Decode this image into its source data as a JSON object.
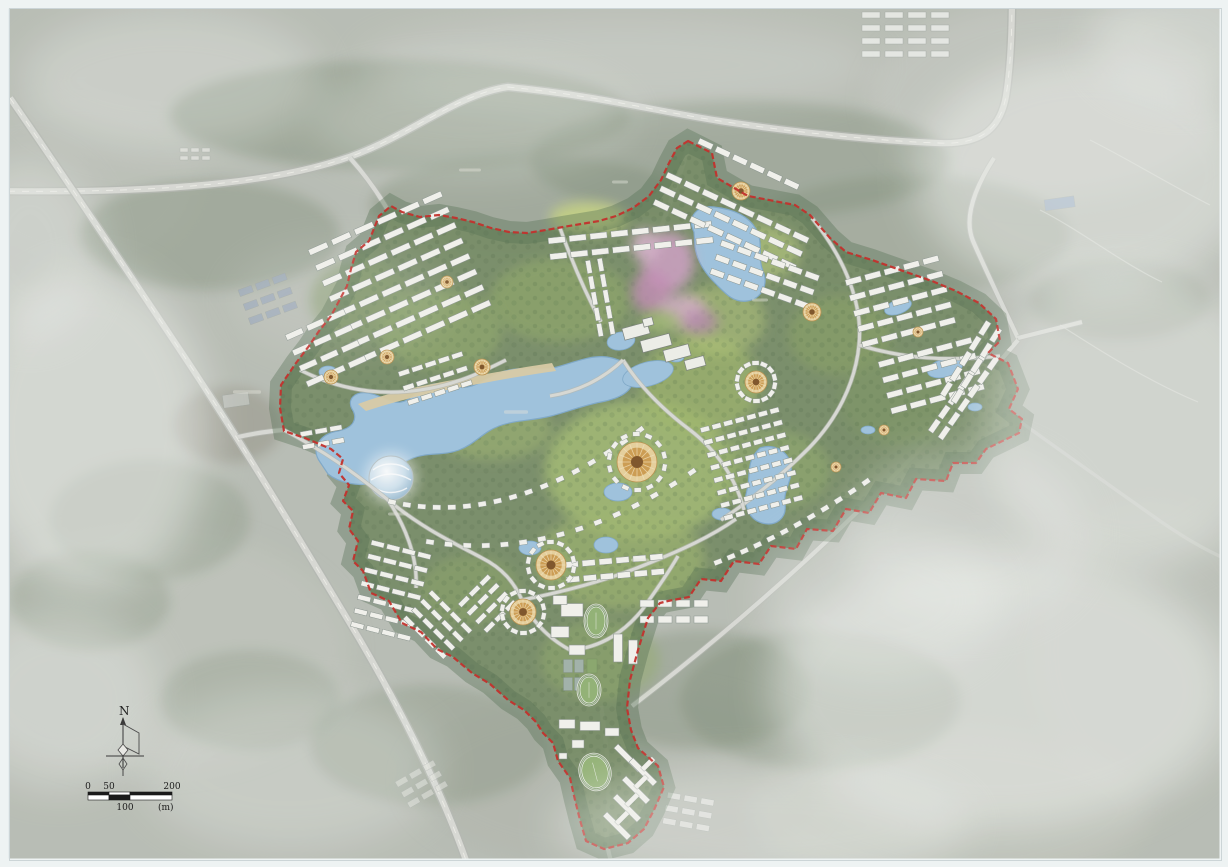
{
  "north_arrow": {
    "label": "N"
  },
  "scale_bar": {
    "tick_0": "0",
    "tick_50": "50",
    "tick_100": "100",
    "tick_200": "200",
    "unit": "(m)"
  },
  "colors": {
    "page_margin": "#eef3f3",
    "aerial_base": "#b7bcb3",
    "boundary_red": "#c22520",
    "lake_blue": "#9cc2de",
    "lake_edge": "#7aa6c8",
    "vegetation": "#70875e",
    "lawn": "#a6bf70",
    "building_white": "#f3f3ee",
    "building_edge": "#85908a",
    "road_light": "#d8dad4",
    "road_casing": "#b3b7b0",
    "beach_sand": "#d9caa2",
    "flower_pink": "#cf9ec4",
    "plaza_orange": "#cd9a4a",
    "fog_white": "#f2f4f1",
    "track_green": "#7d9a6a"
  }
}
